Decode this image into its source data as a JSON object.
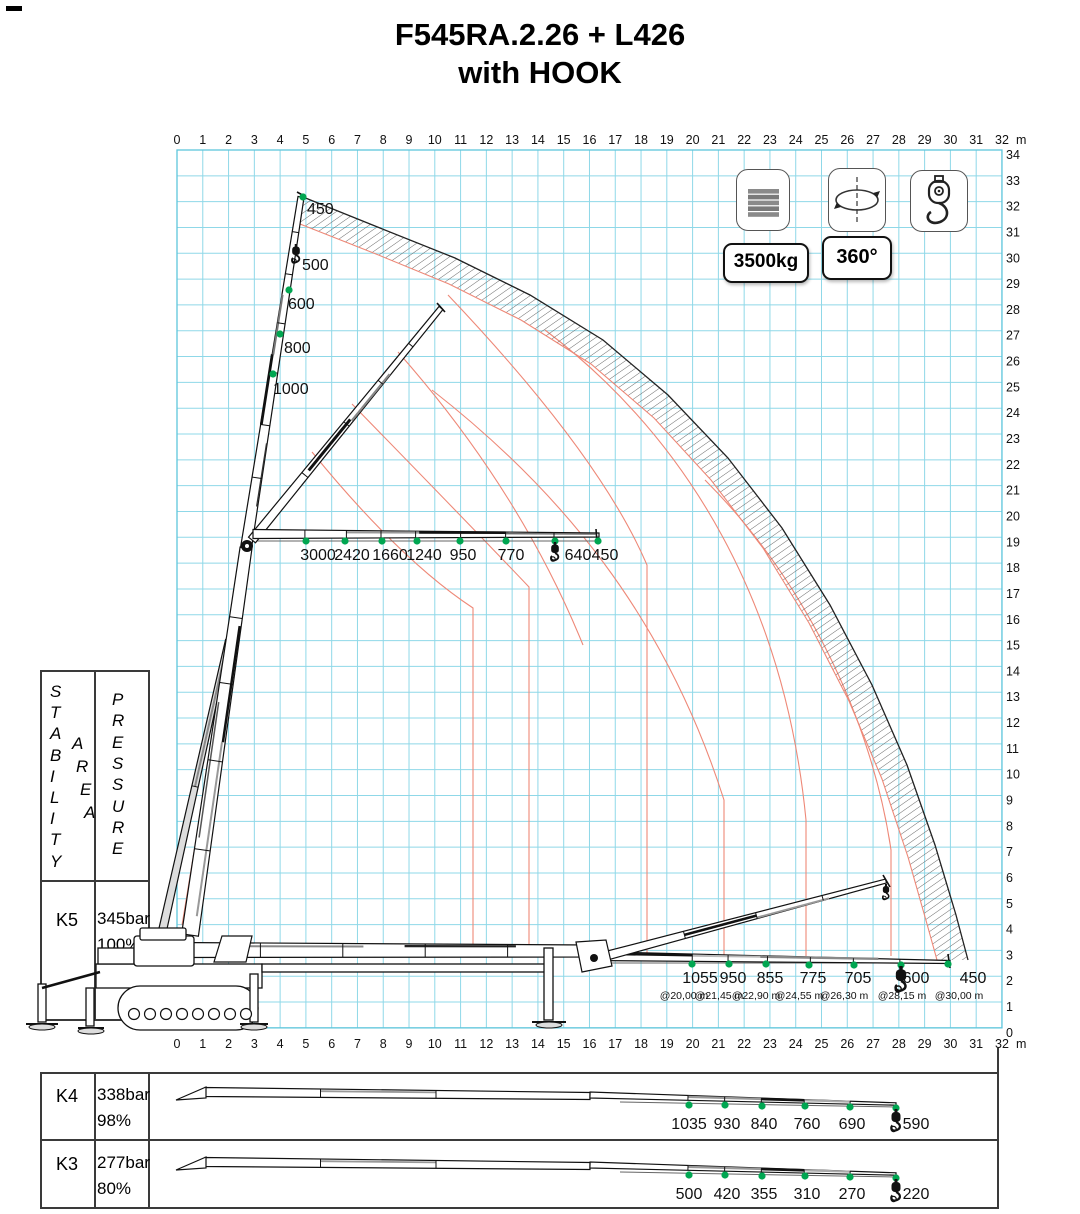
{
  "title": {
    "line1": "F545RA.2.26 + L426",
    "line2": "with HOOK"
  },
  "controls": {
    "capacity_badge": "3500kg",
    "rotation_badge": "360°"
  },
  "icons": {
    "counterweight": "counterweight-icon",
    "rotation": "rotation-360-icon",
    "hook": "hook-icon"
  },
  "axes": {
    "top": {
      "values": [
        "0",
        "1",
        "2",
        "3",
        "4",
        "5",
        "6",
        "7",
        "8",
        "9",
        "10",
        "11",
        "12",
        "13",
        "14",
        "15",
        "16",
        "17",
        "18",
        "19",
        "20",
        "21",
        "22",
        "23",
        "24",
        "25",
        "26",
        "27",
        "28",
        "29",
        "30",
        "31",
        "32"
      ],
      "unit": "m"
    },
    "right": {
      "values": [
        "34",
        "33",
        "32",
        "31",
        "30",
        "29",
        "28",
        "27",
        "26",
        "25",
        "24",
        "23",
        "22",
        "21",
        "20",
        "19",
        "18",
        "17",
        "16",
        "15",
        "14",
        "13",
        "12",
        "11",
        "10",
        "9",
        "8",
        "7",
        "6",
        "5",
        "4",
        "3",
        "2",
        "1",
        "0"
      ]
    },
    "bottom": {
      "values": [
        "0",
        "1",
        "2",
        "3",
        "4",
        "5",
        "6",
        "7",
        "8",
        "9",
        "10",
        "11",
        "12",
        "13",
        "14",
        "15",
        "16",
        "17",
        "18",
        "19",
        "20",
        "21",
        "22",
        "23",
        "24",
        "25",
        "26",
        "27",
        "28",
        "29",
        "30",
        "31",
        "32"
      ],
      "unit": "m"
    }
  },
  "sidebar": {
    "stability": "STABILITY",
    "area": "AREA",
    "pressure": "PRESSURE",
    "rows": [
      {
        "key": "K5",
        "pressure": "345bar",
        "percent": "100%"
      },
      {
        "key": "K4",
        "pressure": "338bar",
        "percent": "98%"
      },
      {
        "key": "K3",
        "pressure": "277bar",
        "percent": "80%"
      }
    ]
  },
  "chart_data": {
    "type": "crane-load-diagram",
    "units": {
      "load": "kg",
      "distance": "m"
    },
    "x_range_m": [
      0,
      32
    ],
    "y_range_m": [
      0,
      34
    ],
    "grid": "1 m cyan grid",
    "vertical_jib_loads": [
      {
        "kg": "450"
      },
      {
        "kg": "500"
      },
      {
        "kg": "600"
      },
      {
        "kg": "800"
      },
      {
        "kg": "1000"
      }
    ],
    "horizontal_jib_loads": [
      {
        "kg": "3000"
      },
      {
        "kg": "2420"
      },
      {
        "kg": "1660"
      },
      {
        "kg": "1240"
      },
      {
        "kg": "950"
      },
      {
        "kg": "770"
      },
      {
        "kg": "640"
      },
      {
        "kg": "450"
      }
    ],
    "ground_boom_loads": [
      {
        "kg": "1055",
        "at": "@20,00 m"
      },
      {
        "kg": "950",
        "at": "@21,45 m"
      },
      {
        "kg": "855",
        "at": "@22,90 m"
      },
      {
        "kg": "775",
        "at": "@24,55 m"
      },
      {
        "kg": "705",
        "at": "@26,30 m"
      },
      {
        "kg": "600",
        "at": "@28,15 m"
      },
      {
        "kg": "450",
        "at": "@30,00 m"
      }
    ],
    "k4_loads": [
      {
        "kg": "1035"
      },
      {
        "kg": "930"
      },
      {
        "kg": "840"
      },
      {
        "kg": "760"
      },
      {
        "kg": "690"
      },
      {
        "kg": "590"
      }
    ],
    "k3_loads": [
      {
        "kg": "500"
      },
      {
        "kg": "420"
      },
      {
        "kg": "355"
      },
      {
        "kg": "310"
      },
      {
        "kg": "270"
      },
      {
        "kg": "220"
      }
    ],
    "colors": {
      "grid": "#8fd8e8",
      "arc": "#ee8877",
      "load_point": "#00a651"
    }
  }
}
